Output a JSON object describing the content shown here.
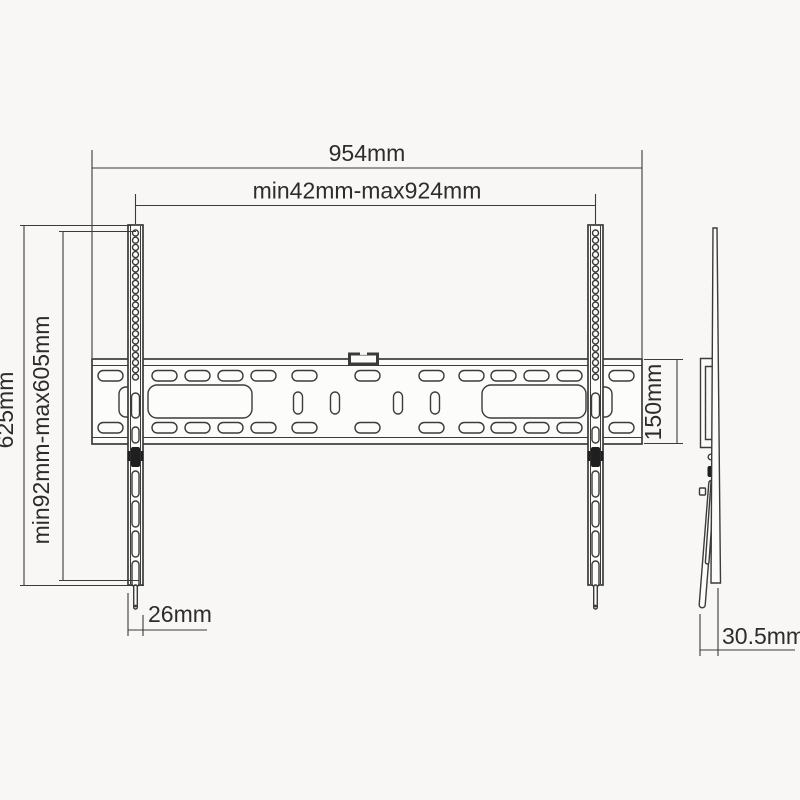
{
  "dimensions": {
    "overall_width": "954mm",
    "vesa_width_range": "min42mm-max924mm",
    "overall_height": "625mm",
    "vesa_height_range": "min92mm-max605mm",
    "wall_plate_height": "150mm",
    "rail_width": "26mm",
    "mount_depth": "30.5mm"
  },
  "colors": {
    "line": "#3b3b3b",
    "background": "#f8f7f5",
    "screw": "#1f1f1f"
  }
}
